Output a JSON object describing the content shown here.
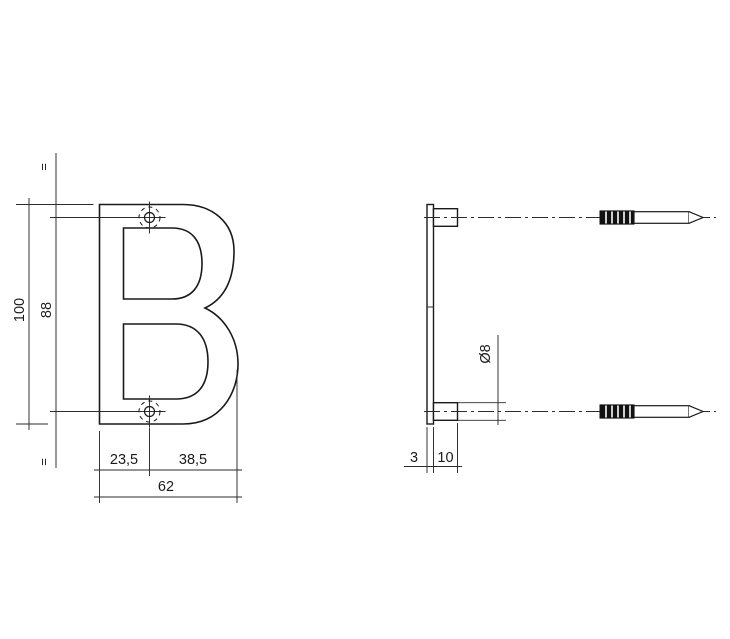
{
  "drawing": {
    "title": "Letter B mounting dimension drawing",
    "product_letter": "B",
    "colors": {
      "line": "#1a1a1a",
      "thin_line": "#2b2b2b",
      "background": "#ffffff",
      "thread_fill": "#111111"
    },
    "front_view": {
      "dim_overall_height": "100",
      "dim_hole_spacing": "88",
      "equal_mark_top": "=",
      "equal_mark_bottom": "=",
      "dim_left_to_hole": "23,5",
      "dim_hole_to_right": "38,5",
      "dim_overall_width": "62"
    },
    "side_view": {
      "dim_boss_diameter": "Ø8",
      "dim_plate_thickness": "3",
      "dim_boss_length": "10"
    }
  }
}
